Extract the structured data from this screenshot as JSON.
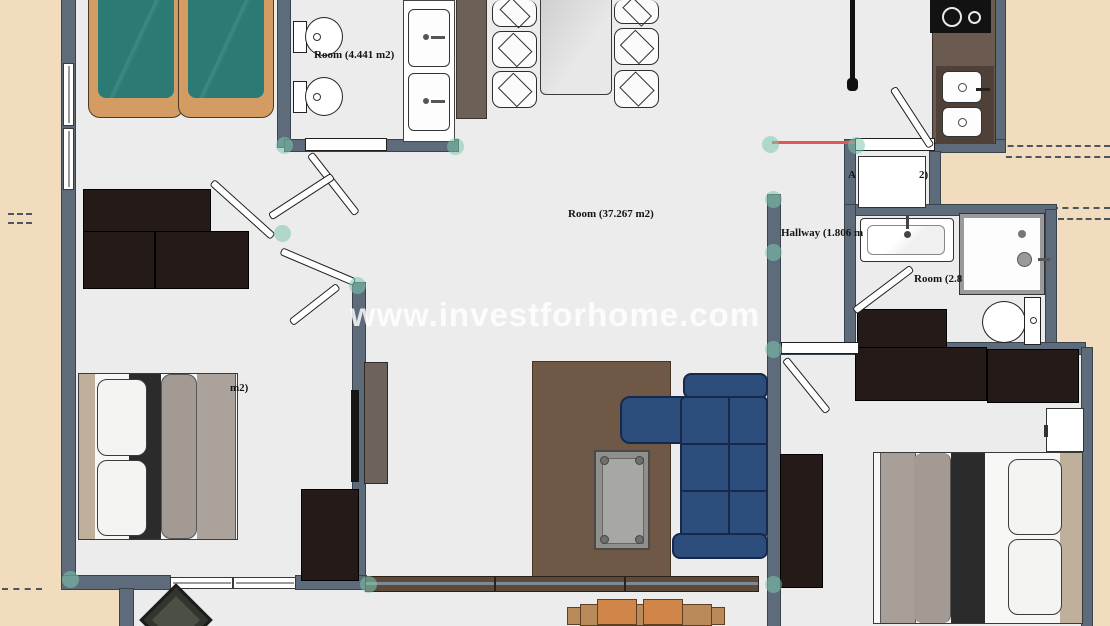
{
  "watermark": "www.investforhome.com",
  "labels": {
    "bedroom_top_left": "Room",
    "bathroom_top": "Room (4.441 m2)",
    "living_room": "Room (37.267 m2)",
    "hallway": "Hallway (1.806 m",
    "bathroom_right": "Room (2.8",
    "utility_fragment_left": "A",
    "utility_fragment_right": "2)",
    "bedroom_bottom_left_fragment": "m2)"
  },
  "colors": {
    "floor": "#ececec",
    "exterior": "#f1ddbd",
    "wall": "#5d6b7a",
    "bed_teal": "#2c7a74",
    "bed_wood": "#d49c62",
    "sofa_blue": "#2d4d7d",
    "rug_brown": "#6f5846",
    "furniture_dark": "#241b18",
    "red_marker": "#e05a52",
    "snap_dot": "#7ec9ae"
  }
}
